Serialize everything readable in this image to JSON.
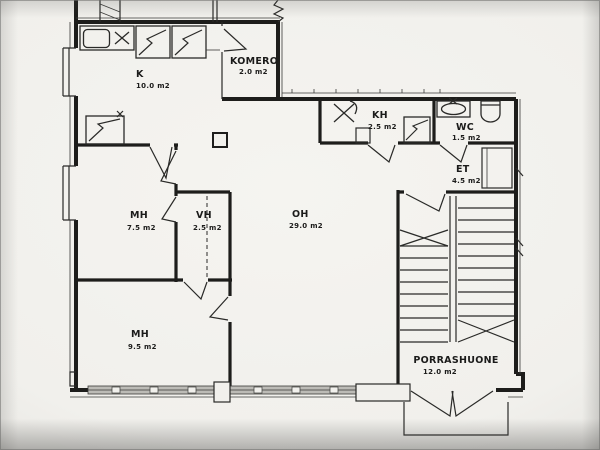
{
  "document": {
    "kind": "apartment floor plan, scanned architectural drawing"
  },
  "rooms": [
    {
      "id": "kitchen",
      "abbr": "K",
      "area": "10.0 m2"
    },
    {
      "id": "closet",
      "abbr": "KOMERO",
      "area": "2.0 m2"
    },
    {
      "id": "bathroom",
      "abbr": "KH",
      "area": "2.5 m2"
    },
    {
      "id": "toilet",
      "abbr": "WC",
      "area": "1.5 m2"
    },
    {
      "id": "entry-hall",
      "abbr": "ET",
      "area": "4.5 m2"
    },
    {
      "id": "bedroom-1",
      "abbr": "MH",
      "area": "7.5 m2"
    },
    {
      "id": "walk-in-closet",
      "abbr": "VH",
      "area": "2.5 m2"
    },
    {
      "id": "living-room",
      "abbr": "OH",
      "area": "29.0 m2"
    },
    {
      "id": "bedroom-2",
      "abbr": "MH",
      "area": "9.5 m2"
    },
    {
      "id": "stairwell",
      "abbr": "PORRASHUONE",
      "area": "12.0 m2"
    }
  ],
  "colors": {
    "paper": "#f1f0ec",
    "ink": "#1d1d1b",
    "window_glazing": "#bcbbb6"
  }
}
